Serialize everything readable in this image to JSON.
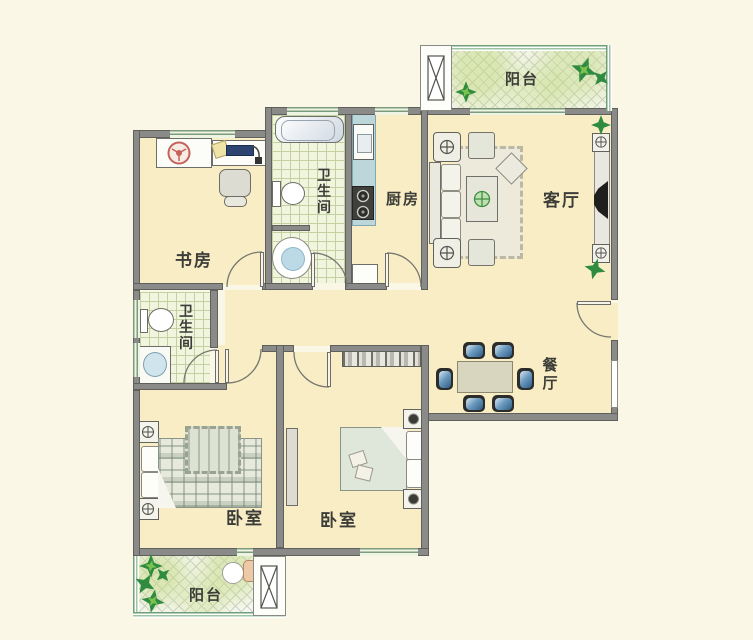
{
  "plan": {
    "type": "apartment-floor-plan",
    "rooms": {
      "balcony_top": {
        "label": "阳台"
      },
      "living_room": {
        "label": "客厅"
      },
      "kitchen": {
        "label": "厨房"
      },
      "bathroom_top": {
        "label": "卫生间",
        "chars": [
          "卫",
          "生",
          "间"
        ]
      },
      "study": {
        "label": "书房"
      },
      "bathroom_left": {
        "label": "卫生间",
        "chars": [
          "卫",
          "生",
          "间"
        ]
      },
      "dining_room": {
        "label": "餐厅",
        "chars": [
          "餐",
          "厅"
        ]
      },
      "bedroom_left": {
        "label": "卧室"
      },
      "bedroom_middle": {
        "label": "卧室"
      },
      "balcony_bottom": {
        "label": "阳台"
      }
    },
    "colors": {
      "background": "#faf7e6",
      "room_floor": "#f8edc5",
      "wall": "#8a8a88",
      "tile_floor": "#f1f5de",
      "counter": "#bcd6da",
      "balcony_wall_green": "#6f9f78",
      "plant_green": "#2e8b40",
      "label_text": "#3d3d38"
    }
  }
}
